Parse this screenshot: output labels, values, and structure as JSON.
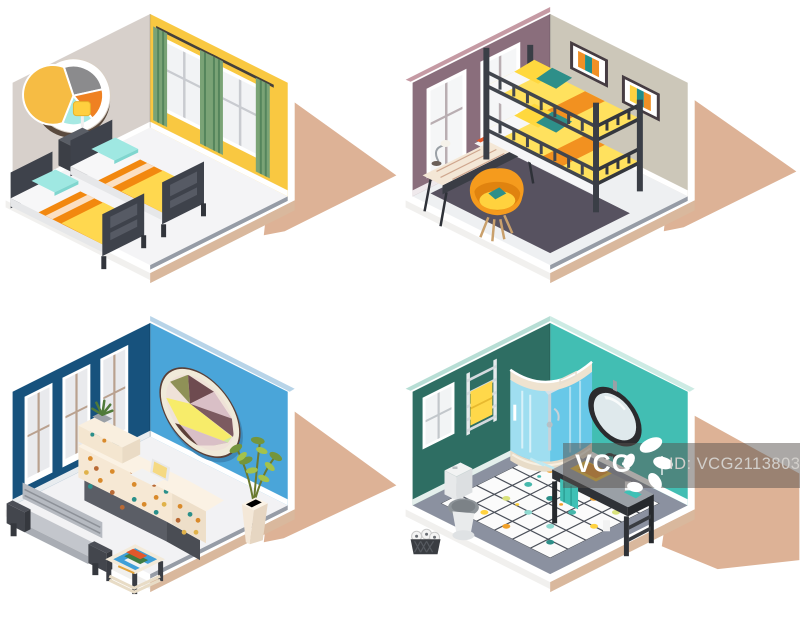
{
  "page": {
    "width": 800,
    "height": 618,
    "background": "#ffffff"
  },
  "watermark": {
    "logo_text": "VCG",
    "id_text": "ID: VCG211380310346",
    "band_color": "rgba(88,82,78,0.5)",
    "logo_color": "#ffffff",
    "id_text_color": "#d2cfcb"
  },
  "illustrations": {
    "set_name": "hostel-interiors-isometric-set",
    "items": [
      {
        "name": "twin-bedroom",
        "label": "Twin bedroom with two beds, nightstand lamp, round segmented mirror, yellow wall, green curtains"
      },
      {
        "name": "bunk-bedroom",
        "label": "Room with dark bunk bed, desk, orange chair, two striped wall pictures"
      },
      {
        "name": "lobby-reception",
        "label": "Lobby with polka-dot reception desk, laptop, bench, plant, coffee table, oval geometric art"
      },
      {
        "name": "bathroom",
        "label": "Bathroom with corner shower cabin, vanity sink, oval mirror, toilet, towel ladder, dotted tile floor"
      }
    ]
  },
  "palette": {
    "shadow_tan": "#ddb296",
    "slab_tan": "#d9b89d",
    "bedroom_left_wall": "#d7d0cb",
    "bedroom_right_wall": "#f9c841",
    "bunkroom_left_wall": "#8a6e7c",
    "bunkroom_right_wall": "#ccc7b9",
    "lobby_left_wall": "#17527d",
    "lobby_right_wall": "#4aa5d9",
    "bath_left_wall": "#2e6e63",
    "bath_right_wall": "#42beb3",
    "accent_orange": "#f29120",
    "accent_yellow": "#ffd84f",
    "accent_teal": "#2e8f89",
    "accent_cyan": "#9fe8e2",
    "frame_dark": "#3e424b"
  }
}
